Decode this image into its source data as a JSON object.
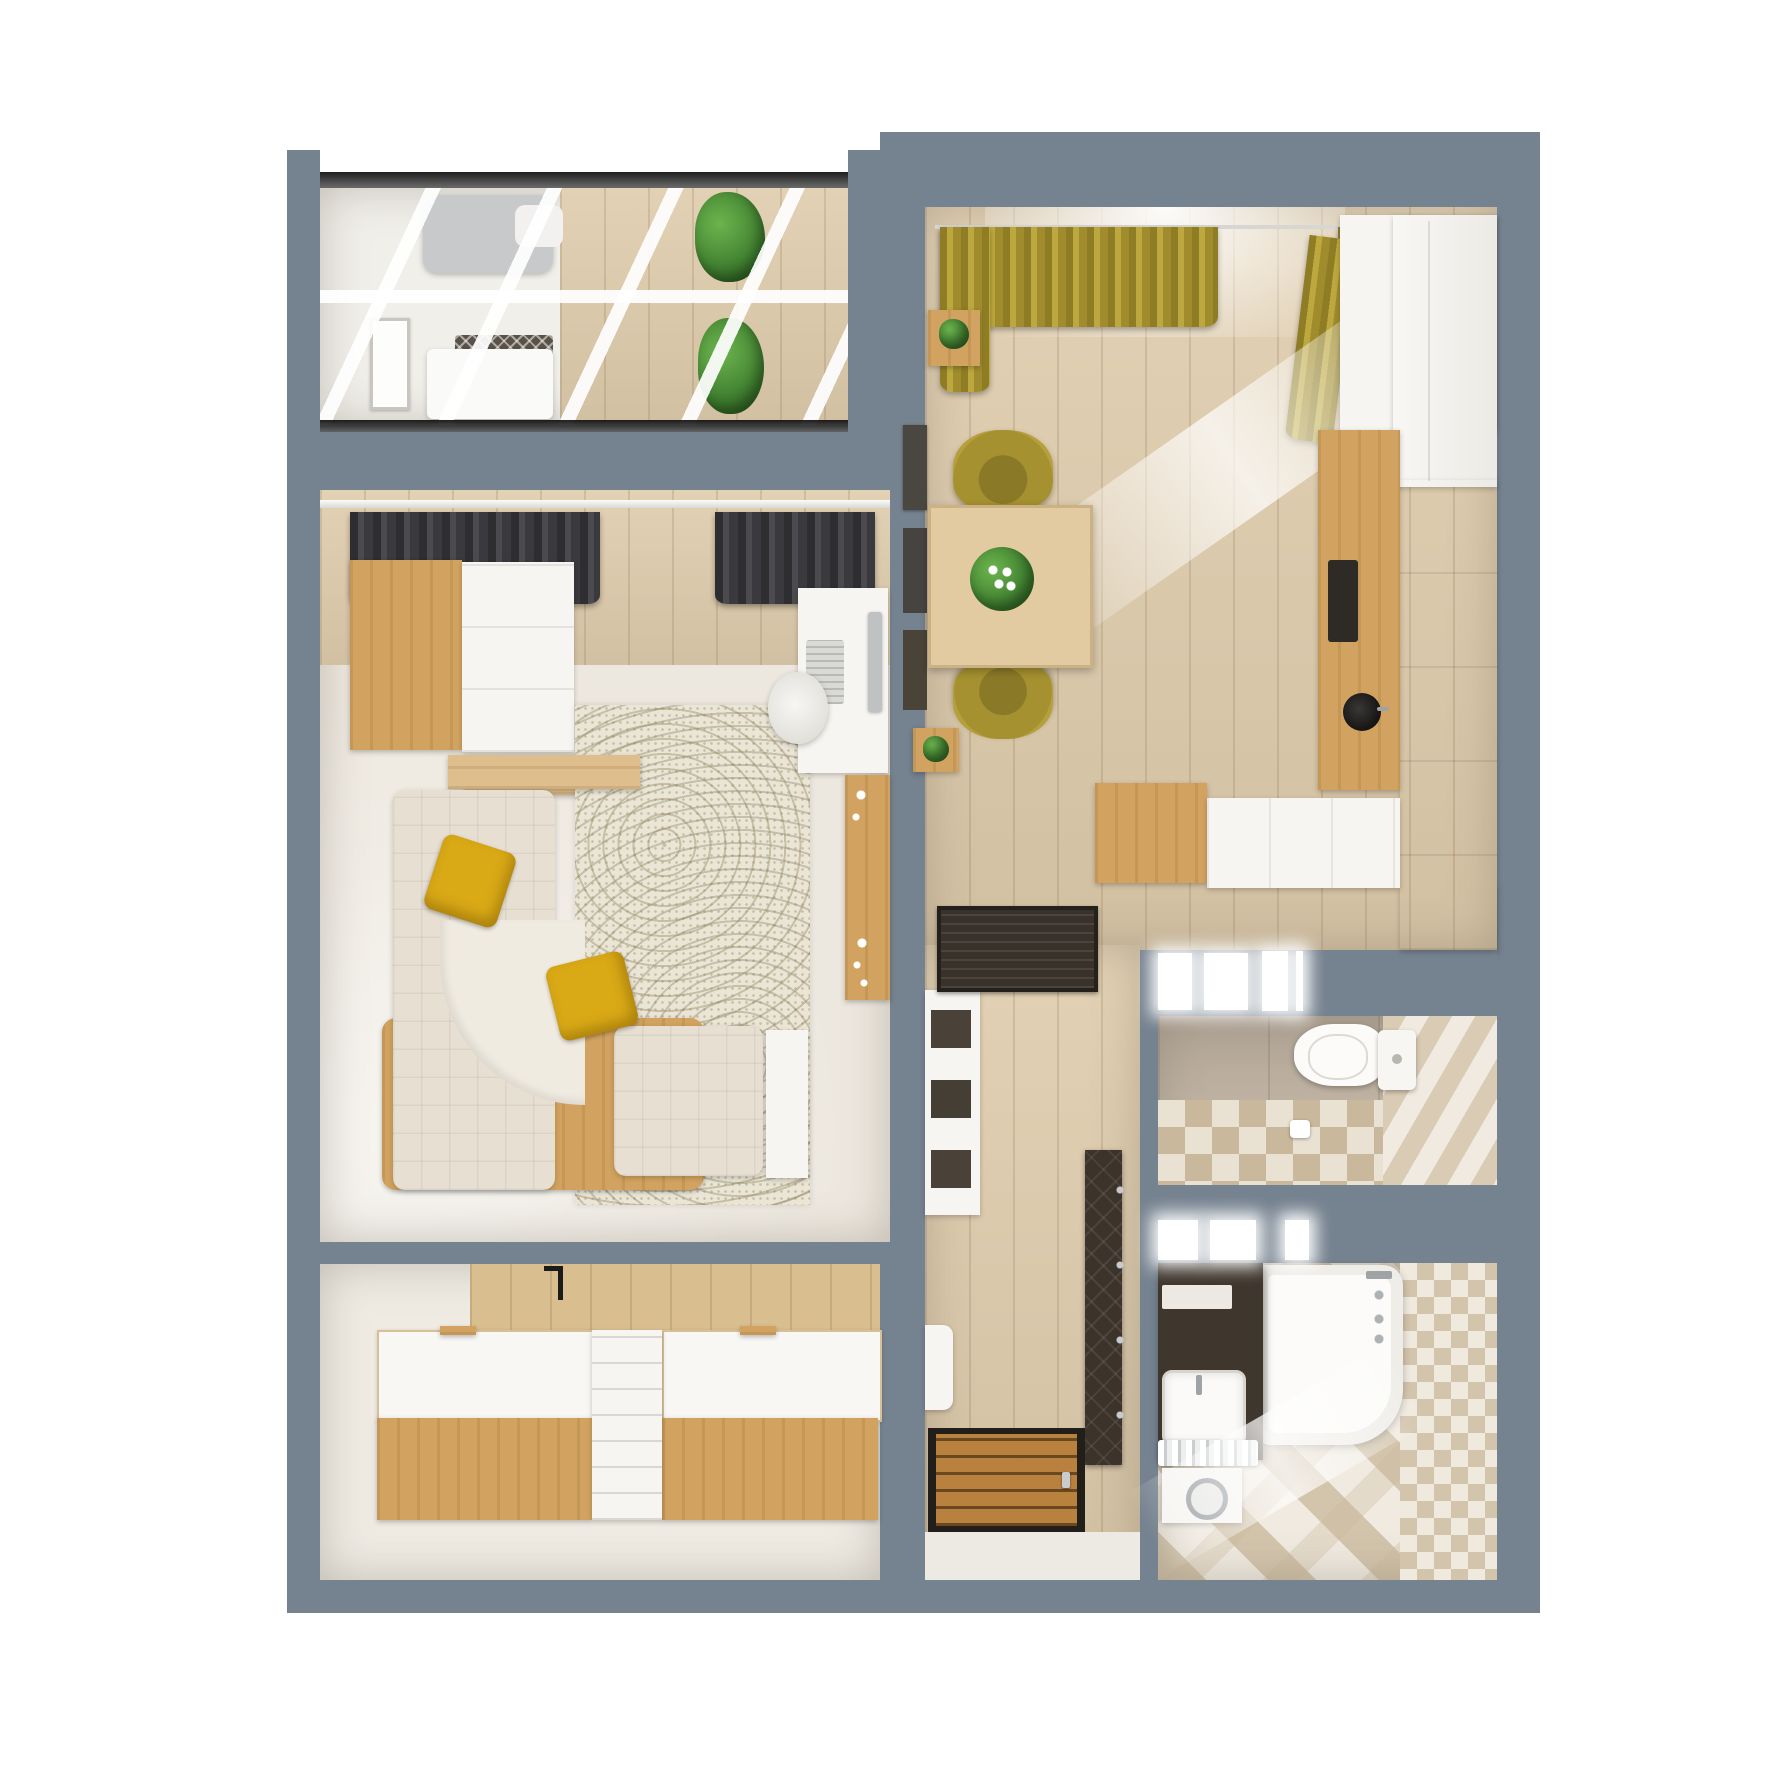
{
  "meta": {
    "title": "One-bedroom apartment 3D floor plan — top-down interior render",
    "view": "top-down cutaway 3D render",
    "visible_text": "none"
  },
  "palette": {
    "bg": "#FFFFFF",
    "walls": "#75828F",
    "wood_floor": "#DFCCAC",
    "carpet": "#EDE8DF",
    "wood_furniture": "#D2A360",
    "yellow": "#D9A916",
    "olive": "#A5912F",
    "dark_curtain": "#3A3A3E",
    "door_wood": "#B9813E",
    "tile_beige": "#C9BBAA",
    "plant_green": "#3F7F2F"
  },
  "rooms": {
    "balcony": {
      "name": "Glazed balcony with daybed",
      "items": [
        "glass-roof-mullions",
        "gray-daybed",
        "white-bed",
        "woven-headboard",
        "picture-frame",
        "potted-plants",
        "wood-floor"
      ]
    },
    "kitchen": {
      "name": "Kitchen-dining room",
      "items": [
        "olive-curtains",
        "window",
        "dining-table",
        "flower-bouquet",
        "olive-chair-top",
        "olive-chair-bottom",
        "plant-side-tables",
        "wall-frames",
        "corner-cabinet",
        "fridge-cabinet",
        "white-cabinet-run",
        "wood-counter",
        "cooktop",
        "round-black-sink",
        "wood-sideboard",
        "white-sideboard",
        "sunlight-streak"
      ]
    },
    "living": {
      "name": "Living room",
      "items": [
        "dark-curtains",
        "balcony-glass-wall",
        "wardrobe-wood",
        "wardrobe-white",
        "wood-console",
        "corner-sofa",
        "sofa-wood-base",
        "yellow-pillow-1",
        "yellow-pillow-2",
        "armchair-section",
        "side-table",
        "mosaic-rug",
        "desk",
        "desk-chair",
        "keyboard",
        "monitor",
        "wood-sideboard-candles"
      ]
    },
    "bedroom": {
      "name": "Bedroom with twin platform beds",
      "items": [
        "wood-panel-headboard-wall",
        "bed-left",
        "bed-right",
        "divider-shelf",
        "wall-lamp"
      ]
    },
    "hallway": {
      "name": "Entrance hallway",
      "items": [
        "doormat",
        "entrance-door",
        "door-handle",
        "shoe-bench",
        "shelf-unit",
        "coat-quilt-panel",
        "coat-hooks",
        "wood-floor"
      ]
    },
    "toilet": {
      "name": "Toilet room",
      "items": [
        "toilet",
        "cistern",
        "toilet-paper",
        "beige-tile-walls",
        "chevron-tile-wall",
        "checker-tile-floor",
        "transom-windows"
      ]
    },
    "bathroom": {
      "name": "Bathroom",
      "items": [
        "bathtub",
        "bath-faucet",
        "dark-vanity-counter",
        "sink",
        "towel-shelf",
        "washing-machine",
        "chevron-tile-floor",
        "checker-tile-wall",
        "transom-windows"
      ]
    }
  },
  "counts": {
    "window_slots_toilet": 4,
    "window_slots_bathroom": 3,
    "dining_chairs": 2,
    "beds": 2,
    "yellow_pillows": 2
  }
}
